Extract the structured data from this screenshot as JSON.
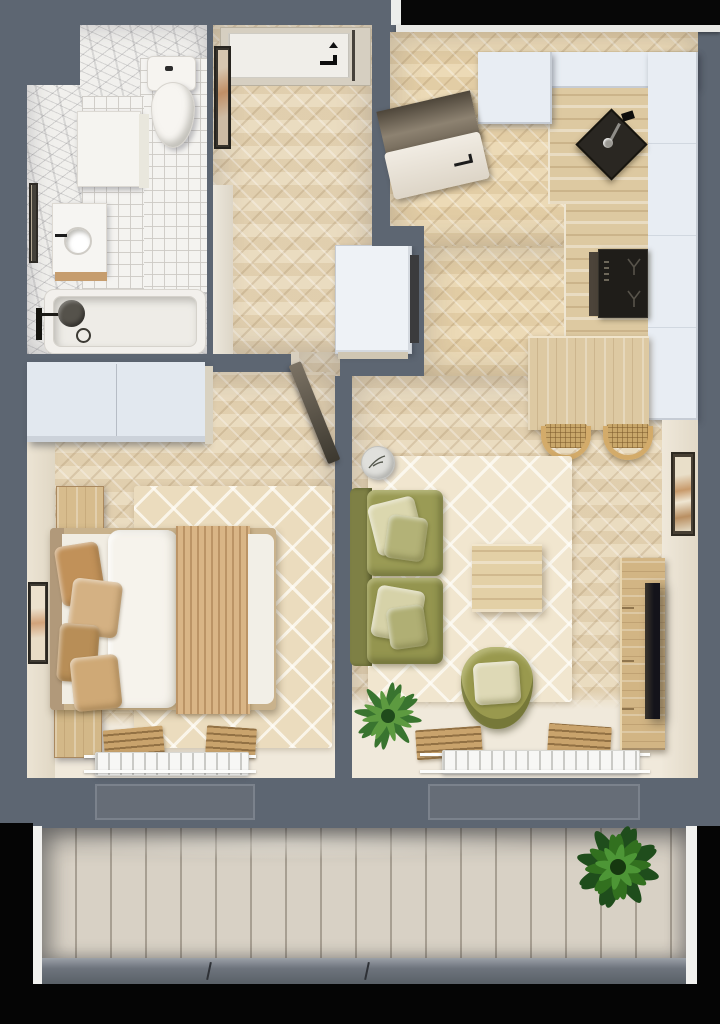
{
  "scene": {
    "type": "apartment floor plan, top-down 3D render",
    "rooms_count": 6
  },
  "palette": {
    "wall": "#5d6672",
    "window_glass": "#070707",
    "parquet": "#e7d7b9",
    "tile": "#f4f3f0",
    "marble": "#f1f0ed",
    "rug_cream": "#f1e6cf",
    "balcony_planks": "#d8d1c5",
    "cabinet_white": "#e8edf3",
    "counter_wood": "#ddc9a1",
    "sofa_olive": "#9a9b55",
    "pillow_cream": "#dbd7ae",
    "bed_duvet": "#f6f3ec",
    "throw_tan": "#d9b586",
    "appliance_black": "#24211d",
    "plant_green": "#3f7a35"
  },
  "rooms": {
    "bathroom": {
      "label": "Bathroom",
      "items": {
        "toilet": "Toilet",
        "washer": "Washing machine",
        "vanity": "Vanity with sink",
        "bathtub": "Bathtub",
        "shower": "Shower set",
        "mirror": "Bathroom mirror"
      }
    },
    "hallway": {
      "label": "Hallway",
      "items": {
        "entry_door": "Entry door",
        "mirror": "Hall mirror",
        "closet": "Built-in closet"
      }
    },
    "kitchen": {
      "label": "Kitchen",
      "items": {
        "window": "Kitchen window",
        "fridge": "Fridge",
        "upper_cabinets": "Upper cabinets",
        "counter": "Worktop",
        "sink": "Kitchen sink",
        "hob": "Induction hob",
        "dining_table": "Dining table",
        "stool_1": "Rattan stool",
        "stool_2": "Rattan stool"
      }
    },
    "bedroom": {
      "label": "Bedroom",
      "items": {
        "wardrobe": "Wardrobe",
        "door": "Bedroom door",
        "bed": "Double bed",
        "pillow": "Pillow",
        "duvet": "Duvet",
        "throw": "Bed throw",
        "nightstand_1": "Nightstand",
        "nightstand_2": "Nightstand",
        "rug": "Bedroom rug",
        "picture": "Wall picture",
        "mat": "Wooden mat",
        "radiator": "Radiator"
      }
    },
    "living_room": {
      "label": "Living room",
      "items": {
        "sofa": "Olive sofa",
        "sofa_pillow": "Sofa pillow",
        "side_table": "Round side table",
        "coffee_table": "Coffee table",
        "armchair": "Armchair",
        "armchair_pillow": "Armchair pillow",
        "plant": "Indoor plant",
        "tv_console": "TV console",
        "tv": "TV",
        "picture": "Wall picture",
        "rug": "Living room rug",
        "mat": "Wooden mat",
        "radiator": "Radiator"
      }
    },
    "balcony": {
      "label": "Balcony",
      "items": {
        "plant": "Balcony plant",
        "railing": "Balcony edge"
      }
    }
  }
}
